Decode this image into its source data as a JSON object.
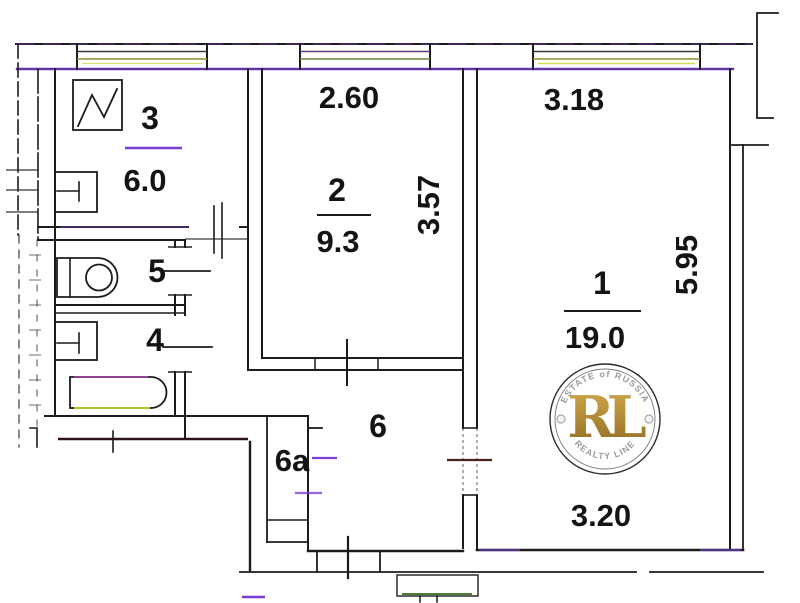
{
  "meta": {
    "type": "apartment-floor-plan"
  },
  "rooms": {
    "r1": {
      "number": "1",
      "area": "19.0"
    },
    "r2": {
      "number": "2",
      "area": "9.3"
    },
    "r3": {
      "number": "3",
      "area": "6.0"
    },
    "r4": {
      "number": "4"
    },
    "r5": {
      "number": "5"
    },
    "r6": {
      "number": "6"
    },
    "r6a": {
      "number": "6a"
    }
  },
  "dimensions": {
    "room2_width": "2.60",
    "room2_depth": "3.57",
    "room1_width": "3.18",
    "room1_depth": "5.95",
    "room1_width_bottom": "3.20"
  },
  "watermark": {
    "arc_top": "ESTATE of RUSSIA",
    "monogram": "RL",
    "arc_bottom": "REALTY LINE"
  },
  "colors": {
    "wall": "#1c1c1c",
    "violet": "#7b3fd6",
    "window_olive": "#8a8f2e",
    "window_yellow": "#c8d332",
    "bath_magenta": "#c846c8",
    "door_red": "#4a2020",
    "mat_green": "#4a7d35",
    "gold_light": "#d4ab4c",
    "gold_dark": "#8f6b22"
  }
}
